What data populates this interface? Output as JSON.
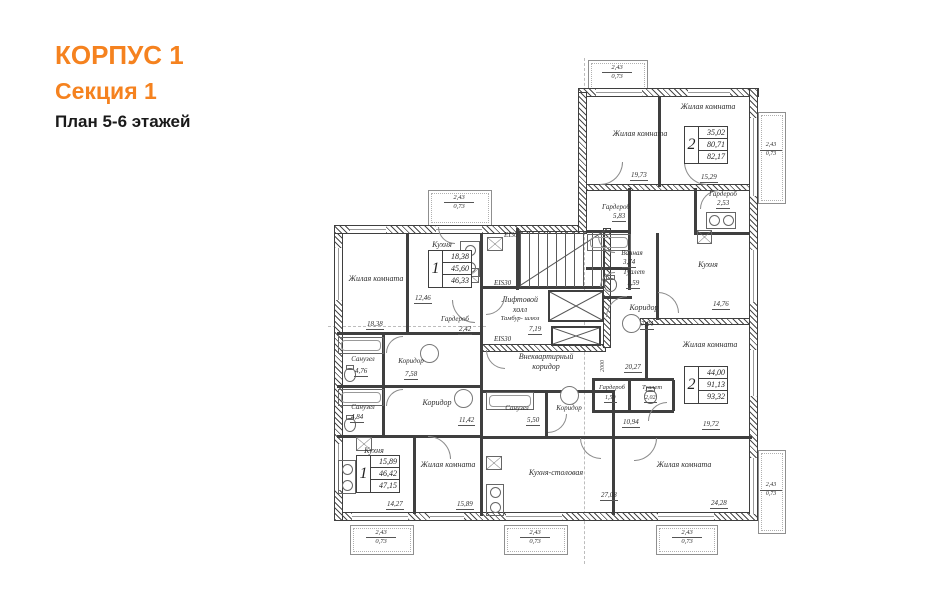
{
  "header": {
    "building": "КОРПУС 1",
    "section": "Секция 1",
    "plan": "План 5-6 этажей"
  },
  "colors": {
    "accent": "#f5821f",
    "ink": "#3f3f3f"
  },
  "apartments": [
    {
      "rooms": "1",
      "living": "18,38",
      "area": "45,60",
      "total": "46,33"
    },
    {
      "rooms": "2",
      "living": "35,02",
      "area": "80,71",
      "total": "82,17"
    },
    {
      "rooms": "2",
      "living": "44,00",
      "area": "91,13",
      "total": "93,32"
    },
    {
      "rooms": "1",
      "living": "15,89",
      "area": "46,42",
      "total": "47,15"
    }
  ],
  "rooms": [
    {
      "name": "Жилая комната",
      "area": "18,38"
    },
    {
      "name": "Кухня",
      "area": "12,46"
    },
    {
      "name": "Гардероб",
      "area": "2,42"
    },
    {
      "name": "Санузел",
      "area": "4,76"
    },
    {
      "name": "Коридор",
      "area": "7,58"
    },
    {
      "name": "Санузел",
      "area": "4,84"
    },
    {
      "name": "Коридор",
      "area": "11,42"
    },
    {
      "name": "Кухня",
      "area": "14,27"
    },
    {
      "name": "Жилая комната",
      "area": "15,89"
    },
    {
      "name": "Жилая комната",
      "area": "19,73"
    },
    {
      "name": "Жилая комната",
      "area": "15,29"
    },
    {
      "name": "Гардероб",
      "area": "5,83"
    },
    {
      "name": "Гардероб",
      "area": "2,53"
    },
    {
      "name": "Ванная",
      "area": "3,74"
    },
    {
      "name": "Туалет",
      "area": "1,59"
    },
    {
      "name": "Кухня",
      "area": "14,76"
    },
    {
      "name": "Коридор",
      "area": "7,24"
    },
    {
      "name": "Жилая комната",
      "area": "19,72"
    },
    {
      "name": "Коридор",
      "area": "10,94"
    },
    {
      "name": "Санузел",
      "area": "5,50"
    },
    {
      "name": "Гардероб",
      "area": "1,59"
    },
    {
      "name": "Туалет",
      "area": "2,02"
    },
    {
      "name": "Кухня-столовая",
      "area": "27,08"
    },
    {
      "name": "Жилая комната",
      "area": "24,28"
    }
  ],
  "core": {
    "stair_rating": "EI30",
    "door_rating_top": "EIS30",
    "door_rating_bottom": "EIS30",
    "lift_hall": "Лифтовой холл",
    "tambour": "Тамбур- шлюз",
    "lift_hall_area": "7,19",
    "common_corridor": "Внеквартирный коридор",
    "common_corridor_area": "20,27",
    "dim_2000": "2000"
  },
  "balcony": {
    "w": "2,43",
    "k": "0,73"
  }
}
